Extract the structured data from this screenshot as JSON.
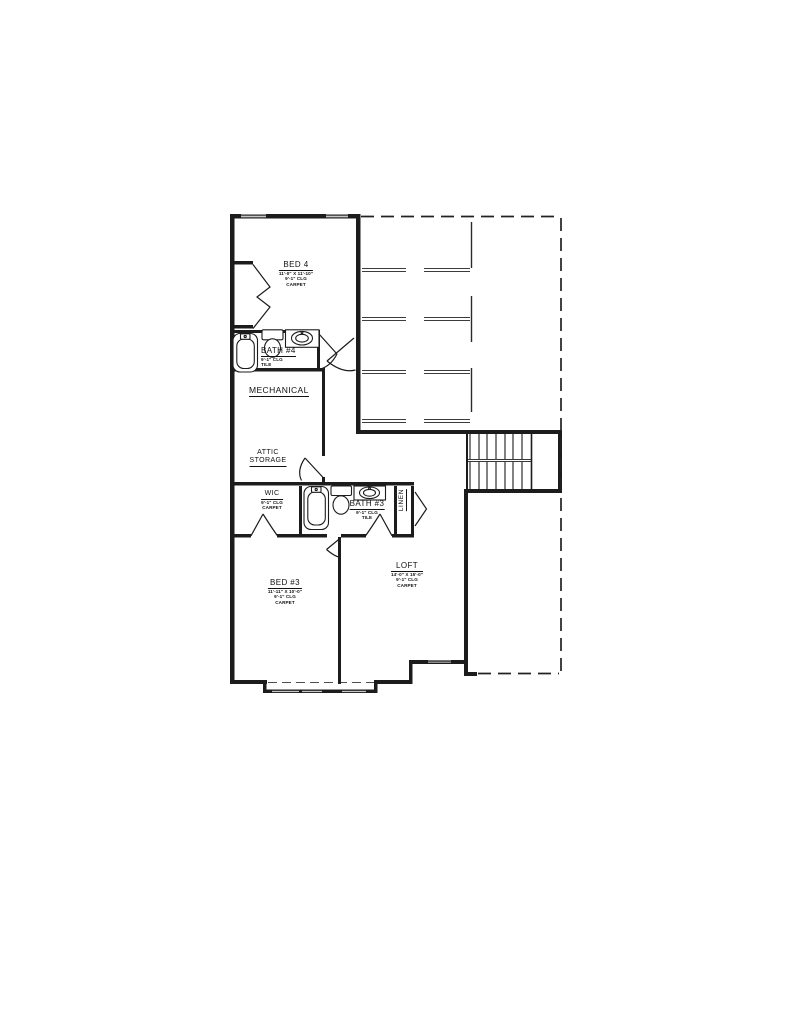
{
  "drawing": {
    "type": "floor-plan",
    "colors": {
      "line": "#1c1c1c",
      "background": "#ffffff",
      "joist_line": "#3c3c3c"
    },
    "icons": {
      "bathtub": "rounded-rect-with-faucet",
      "toilet": "tank-and-bowl",
      "sink": "oval-basin-in-counter",
      "stairs": "parallel-treads",
      "door": "quarter-arc-swing",
      "bifold-closet-door": "zigzag",
      "window": "thin-lines-in-wall-gap",
      "open-area-boundary": "dashed-line"
    },
    "rooms": {
      "bed4": {
        "name": "BED 4",
        "dims": "11'-0\" X 11'-10\"",
        "clg": "9'-1\" CLG",
        "floor": "CARPET"
      },
      "bath4": {
        "name": "BATH #4",
        "clg": "9'-1\" CLG",
        "floor": "TILE"
      },
      "mechanical": {
        "name": "MECHANICAL"
      },
      "attic": {
        "line1": "ATTIC",
        "line2": "STORAGE"
      },
      "wic": {
        "name": "WIC",
        "clg": "9'-1\" CLG",
        "floor": "CARPET"
      },
      "bath3": {
        "name": "BATH #3",
        "clg": "9'-1\" CLG",
        "floor": "TILE"
      },
      "linen": {
        "name": "LINEN"
      },
      "bed3": {
        "name": "BED #3",
        "dims": "11'-11\" X 10'-0\"",
        "clg": "9'-1\" CLG",
        "floor": "CARPET"
      },
      "loft": {
        "name": "LOFT",
        "dims": "14'-0\" X 15'-0\"",
        "clg": "9'-1\" CLG",
        "floor": "CARPET"
      }
    }
  }
}
